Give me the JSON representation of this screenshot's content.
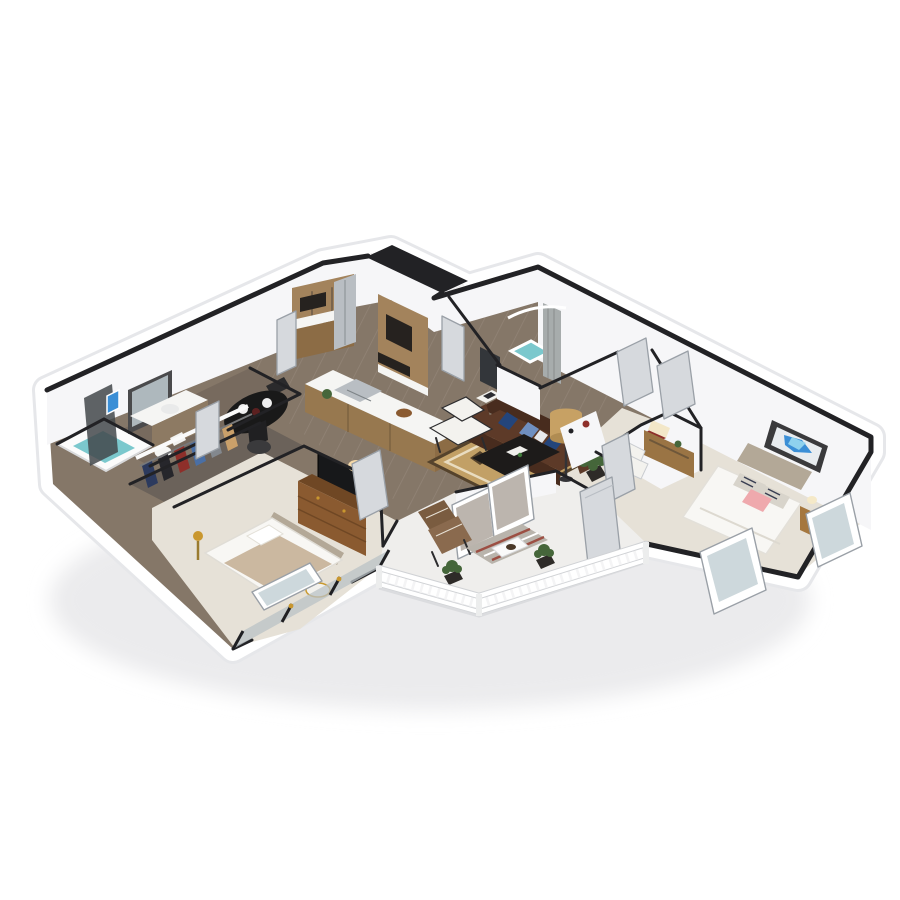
{
  "scene": {
    "type": "3d-isometric-floor-plan-render",
    "visible_text": "",
    "background": "#ffffff",
    "units": "two-bedroom two-bath apartment with balcony"
  },
  "palette": {
    "wall_cap": "#222225",
    "wall_face": "#f6f6f8",
    "skirt": "#ffffff",
    "skirt_edge": "#e6e7ea",
    "wood_floor": "#857768",
    "wood_floor_dark": "#776a5e",
    "wood_plank": "#a2958a",
    "carpet": "#e6e1d7",
    "closet_floor": "#6b625a",
    "balcony_floor": "#efeeec",
    "teal": "#7bc8cd",
    "cabinet_wood": "#a3835c",
    "cabinet_wood_dark": "#8c6c45",
    "counter": "#f5f5f3",
    "stainless": "#b9bec3",
    "appliance": "#26221f",
    "island_wood": "#97784f",
    "sofa": "#5d3a28",
    "sofa_dark": "#482c1e",
    "pillow_navy": "#24457b",
    "pillow_blue": "#6f8fc0",
    "rug_base": "#c2a066",
    "rug_dark": "#55432c",
    "rug_cream": "#e9dcc0",
    "coffee_table": "#1d1b1a",
    "chair_white": "#f3f2ee",
    "lamp_shade": "#c7a164",
    "plant": "#45663a",
    "pot_dark": "#2e2b28",
    "door": "#d6d9dd",
    "door_edge": "#9aa0a7",
    "glass": "#cdd8dc",
    "dresser": "#8a5a30",
    "dresser_dark": "#6f4724",
    "tv": "#17181a",
    "headboard": "#b3a897",
    "bed_white": "#f8f7f4",
    "blanket_tan": "#cbb8a0",
    "pillow_pink": "#efa9ad",
    "art_frame": "#3a3a3c",
    "art_blue": "#3b8fd6",
    "art_blue_light": "#8fd2ee",
    "nightstand": "#a5773f",
    "desk_wood": "#9a7444",
    "railing": "#f4f4f5",
    "railing_shadow": "#d7d8db",
    "curtain": "#a7acac",
    "balcony_rug": "#b9b4ac",
    "balcony_rug_red": "#9c4f43",
    "gold": "#c9972f",
    "table_black": "#191919",
    "clothes1": "#2c3a5e",
    "clothes2": "#26262b",
    "clothes3": "#8e2f2a",
    "clothes4": "#4a6fa5",
    "clothes5": "#83888e",
    "clothes6": "#caa06a"
  },
  "rooms": [
    {
      "id": "kitchen",
      "floor": "wood",
      "features": [
        "upper-cabinets",
        "lower-cabinets",
        "refrigerator",
        "wall-oven",
        "cooktop",
        "island-with-sink",
        "fruit-basket",
        "potted-plant"
      ]
    },
    {
      "id": "dining-area",
      "floor": "wood",
      "features": [
        "round-black-table",
        "place-settings",
        "two-chairs",
        "storage-basket"
      ]
    },
    {
      "id": "living-room",
      "floor": "wood",
      "features": [
        "chesterfield-sofa",
        "navy-pillows",
        "white-armchair",
        "black-coffee-table",
        "diamond-pattern-rug",
        "drum-floor-lamp",
        "potted-plant",
        "side-table"
      ]
    },
    {
      "id": "bathroom-1",
      "floor": "wood",
      "features": [
        "bathtub",
        "shower-glass",
        "vanity-with-sink",
        "mirror",
        "toilet",
        "wall-art"
      ]
    },
    {
      "id": "walk-in-closet",
      "floor": "dark-wood",
      "features": [
        "hanging-clothes",
        "shelf"
      ]
    },
    {
      "id": "bedroom-2",
      "floor": "carpet",
      "features": [
        "bed-tan-blanket",
        "glazed-window-wall",
        "open-casement-window",
        "media-dresser",
        "tv",
        "table-lamp",
        "round-side-table"
      ]
    },
    {
      "id": "bathroom-2",
      "floor": "wood",
      "features": [
        "walk-in-shower",
        "shower-curtain",
        "curved-rod",
        "dark-vanity-panel"
      ]
    },
    {
      "id": "entry-hall",
      "floor": "carpet",
      "features": [
        "angled-corner-closet",
        "open-doors",
        "red-hanging-clothes"
      ]
    },
    {
      "id": "bedroom-1",
      "floor": "carpet",
      "features": [
        "bed-gray-headboard",
        "striped-pillows",
        "pink-pillow",
        "blue-abstract-art",
        "desk",
        "desk-lamp",
        "white-chair",
        "nightstand",
        "open-casement-windows"
      ]
    },
    {
      "id": "balcony",
      "floor": "concrete",
      "features": [
        "white-railing",
        "lounge-chair",
        "striped-rug",
        "small-table",
        "two-planter-boxes",
        "open-entry-door",
        "sliding-glass-door"
      ]
    }
  ]
}
